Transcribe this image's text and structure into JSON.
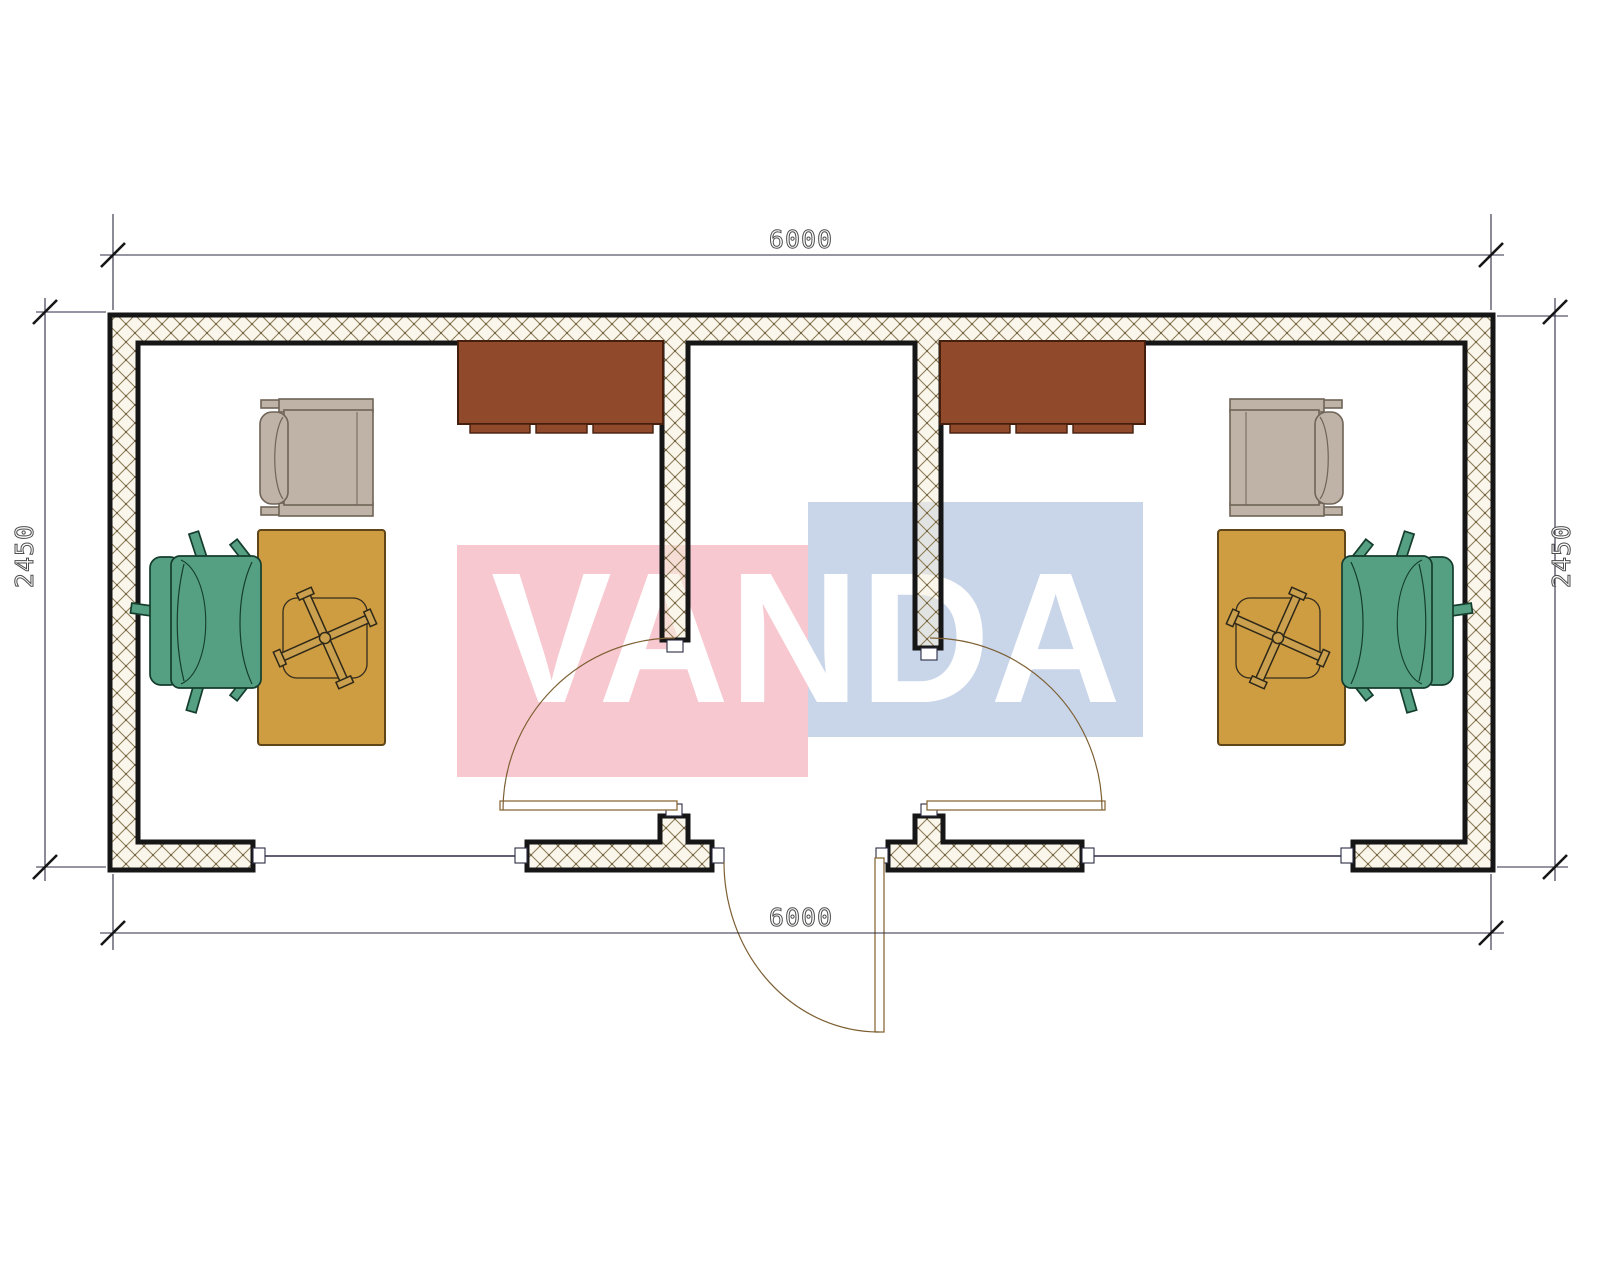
{
  "drawing": {
    "type": "architectural floor plan",
    "units": "mm",
    "watermark": {
      "text": "VANDA",
      "pink_color": "#f7c8cf",
      "blue_color": "#c9d6ea",
      "text_color": "#ffffff"
    },
    "dimensions": {
      "top_width": "6000",
      "bottom_width": "6000",
      "left_height": "2450",
      "right_height": "2450"
    },
    "colors": {
      "wall_line": "#161616",
      "hatch_line": "#8d7c55",
      "hatch_fill": "#f6efdd",
      "dim_line": "#2c2c44",
      "dim_text": "#4d4d4d",
      "door_arc": "#7d5f33",
      "desk": "#ce9c41",
      "task_chair": "#55a083",
      "guest_chair": "#beb3a6",
      "cabinet": "#91492b"
    },
    "rooms": [
      {
        "name": "office-left",
        "furniture": [
          "wall-cabinet",
          "guest-chair",
          "desk",
          "task-chair"
        ],
        "door": "hinged door opening into room",
        "window": "bottom wall"
      },
      {
        "name": "office-right",
        "furniture": [
          "wall-cabinet",
          "guest-chair",
          "desk",
          "task-chair"
        ],
        "door": "hinged door opening into room",
        "window": "bottom wall"
      },
      {
        "name": "entrance-lobby",
        "door": "exterior hinged door opening outward"
      }
    ]
  }
}
